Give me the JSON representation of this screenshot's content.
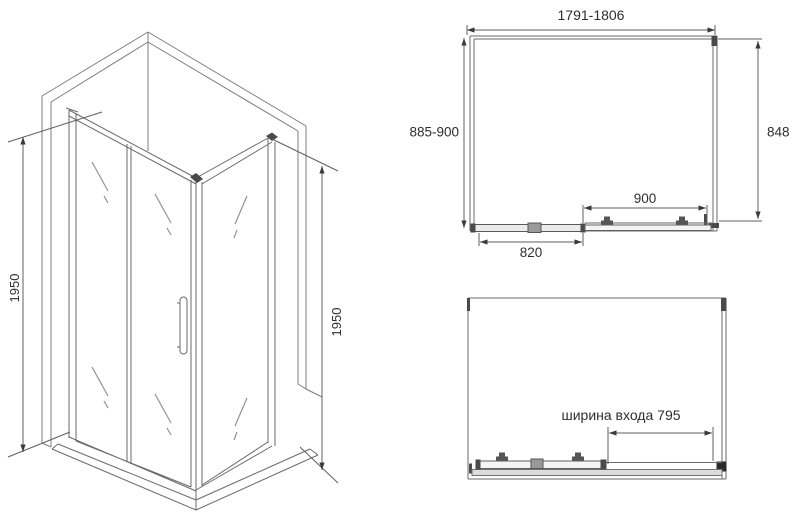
{
  "drawing": {
    "kind": "shower-enclosure-technical-drawing",
    "background": "#ffffff",
    "colors": {
      "line": "#6a6a6a",
      "line_light": "#7e7e7e",
      "glass_mark": "#929292",
      "dimension": "#5f5f5f",
      "arrow": "#3a3a3a",
      "hardware_dark": "#4a4a4a",
      "text": "#2e2e2e"
    },
    "isometric_view": {
      "height_left": "1950",
      "height_right": "1950"
    },
    "top_plan_view": {
      "width_range": "1791-1806",
      "depth_range": "885-900",
      "side_depth": "848",
      "door_section": "900",
      "fixed_section": "820"
    },
    "open_plan_view": {
      "entrance_width": "ширина входа 795"
    }
  }
}
